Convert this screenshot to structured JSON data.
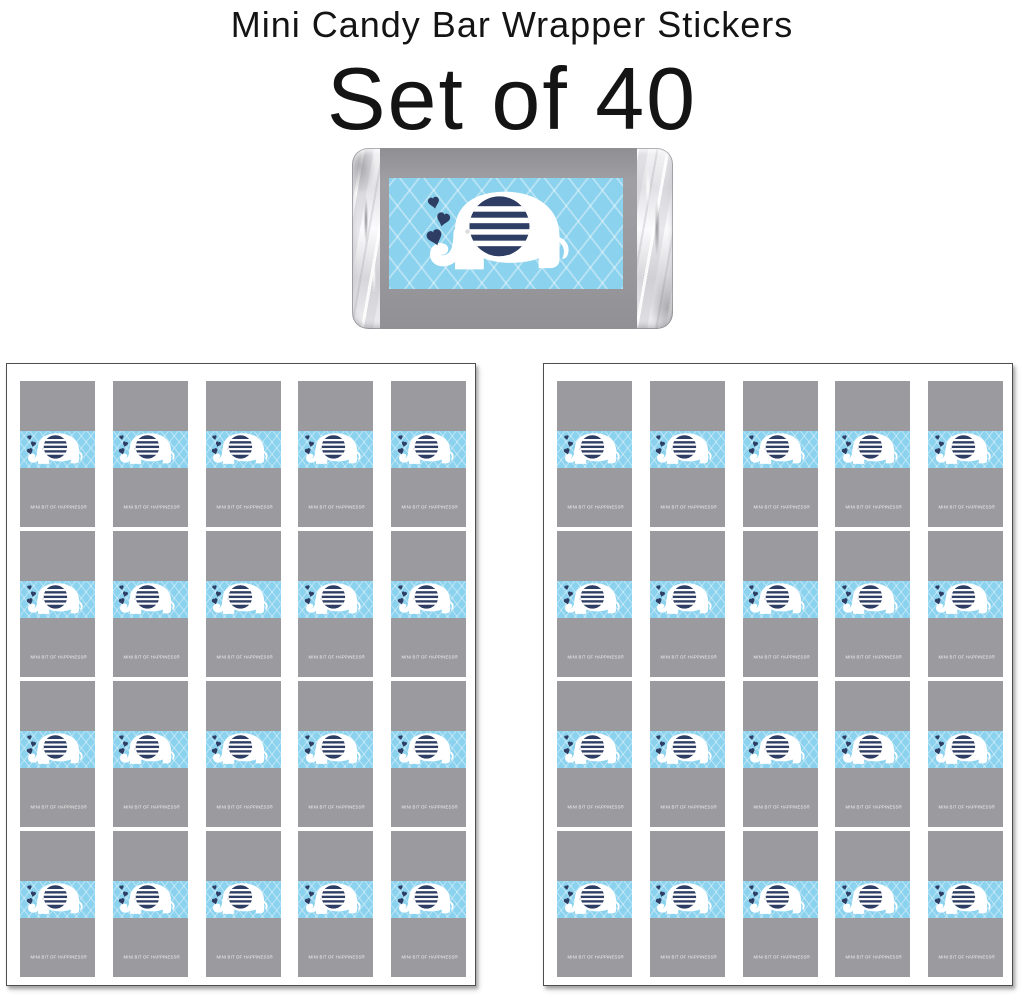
{
  "header": {
    "title": "Mini Candy Bar Wrapper Stickers",
    "subtitle": "Set of 40"
  },
  "wrapper": {
    "back_text": "MINI BIT OF HAPPINESS®",
    "icon": "elephant-with-heart-spray-icon",
    "colors": {
      "blue": "#8bd2ee",
      "lattice": "rgba(255,255,255,0.38)",
      "navy": "#2e3d63",
      "gray_band": "#9b9b9f",
      "foil_silver": "#e9e9ec",
      "elephant_white": "#ffffff"
    }
  },
  "sheets": {
    "count": 2,
    "columns": 5,
    "rows": 4,
    "stickers_per_sheet": 20,
    "total_stickers": 40
  }
}
